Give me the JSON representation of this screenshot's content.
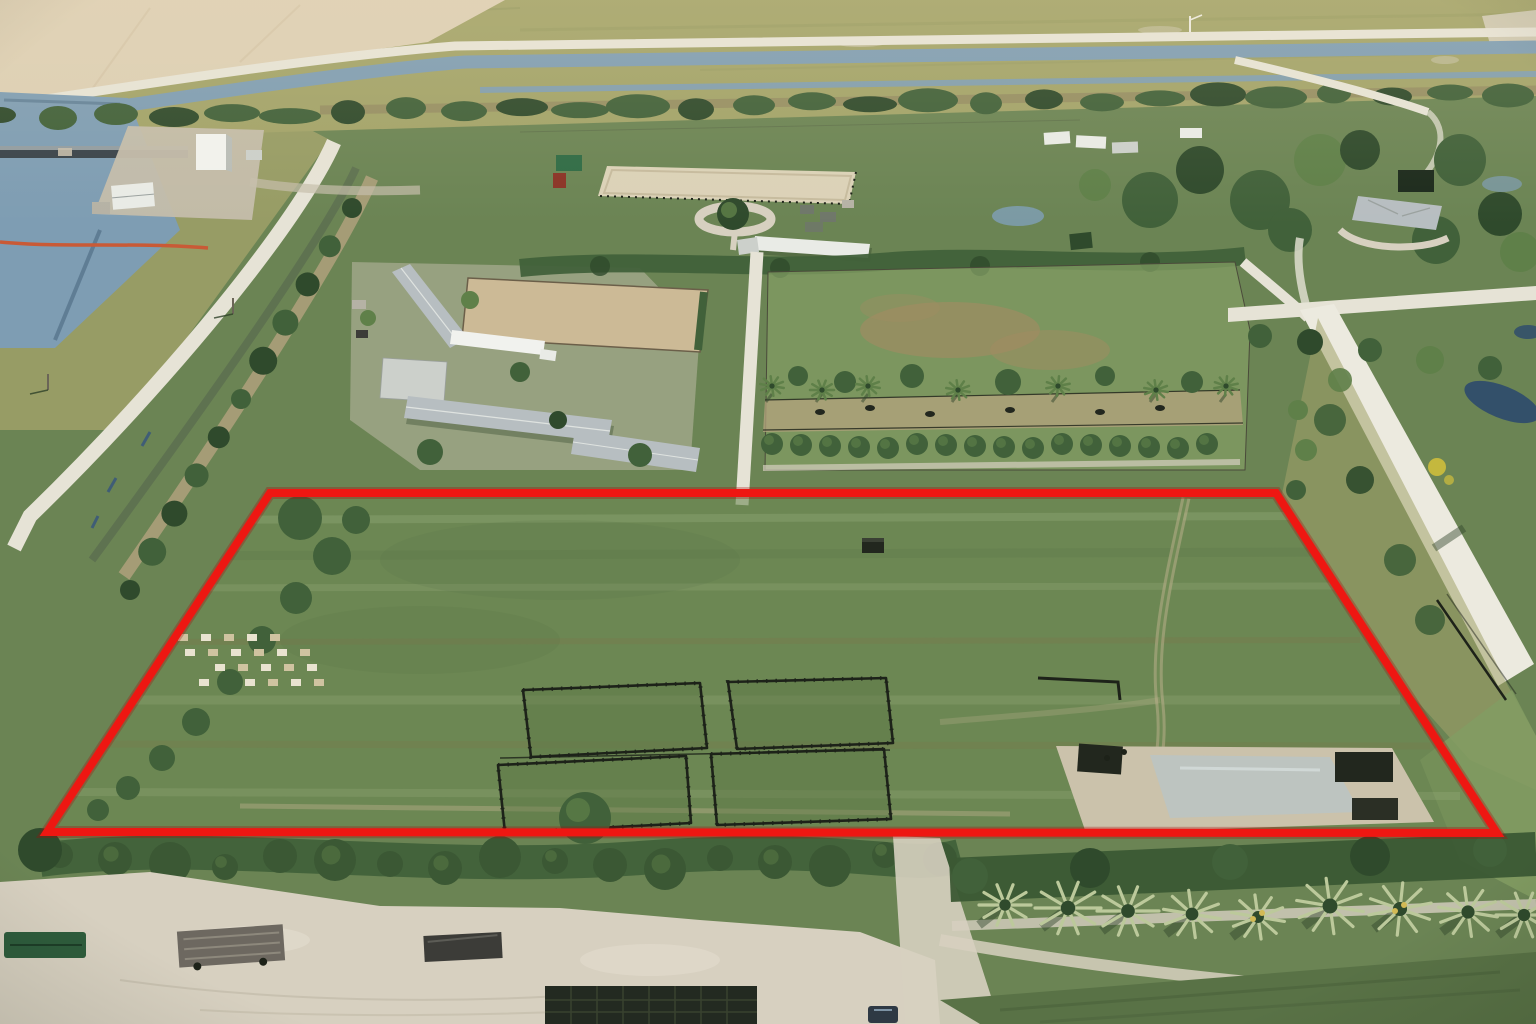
{
  "scene": {
    "kind": "aerial-drone-photo",
    "subject": "Aerial drone photo of a vacant grass parcel outlined in red, surrounded by rural equestrian farms, canals, levee roads, paddocks, palm trees and sandy lanes",
    "width_px": 1536,
    "height_px": 1024
  },
  "parcel": {
    "boundary_points": "270,493 1276,493 1497,833 47,832",
    "boundary_stroke_px": 8
  },
  "palette": {
    "red": "#ee1712",
    "red_halo": "#a80b0b",
    "grass": "#6b8454",
    "grass_light": "#829c63",
    "grass_dark": "#597246",
    "lawn": "#7fa05c",
    "parcel_grass": "#6d8953",
    "paddock_grass": "#5e7847",
    "field_tan": "#dccfb4",
    "marsh": "#a2a369",
    "marsh_dark": "#878f58",
    "water": "#7e9db3",
    "water_dark": "#3f5d76",
    "pond_dark": "#33506a",
    "road_white": "#e6e3d6",
    "road_bright": "#eceadf",
    "road_dirt": "#b4a37e",
    "track": "#b9ae8a",
    "sand": "#d7d0c0",
    "sand_dark": "#c4bdab",
    "dirt_band": "#8c7f5f",
    "ditch": "#5d7050",
    "tree": "#41613a",
    "tree_light": "#5f8049",
    "tree_dark": "#2f4a2c",
    "hedge": "#3b5834",
    "palm_pale": "#bcc99b",
    "palm_yellow": "#d2ba55",
    "palm_shadow": "#31452c",
    "roof_white": "#e9ebe6",
    "roof_gray": "#b7bec1",
    "roof_flat": "#ccd0cb",
    "roof_green": "#2f6b45",
    "roof_line": "#9aa19f",
    "bldg_white": "#f1f2ee",
    "bldg_shade": "#b9bdb7",
    "shed_gray": "#b5b2a5",
    "shed_slate": "#6f776a",
    "shed_red": "#8a3326",
    "arena": "#dbd2b8",
    "arena_line": "#c6bb9e",
    "dirt_paddock": "#ccba96",
    "fence": "#1d2219",
    "shadow": "#2e4128",
    "boom": "#c95a36",
    "dam": "#39434a",
    "dam_light": "#a9b3b7",
    "hive_a": "#e9e3d0",
    "hive_b": "#cfc3a0",
    "debris": "#22271e",
    "wet": "#b9c4c6",
    "wet_sand": "#cbc2ab",
    "trailer_deck": "#6d6860",
    "trailer_dark": "#3c3c38",
    "boat_green": "#2e5c3c",
    "tarp": "#232a21",
    "tarp_seam": "#39422f",
    "car": "#2e3944",
    "pole": "#6b6557",
    "streak_light": "#d6e0b8",
    "streak_brown": "#7e744b",
    "patch_brown": "#a18c62",
    "bush_yellow": "#c4b83e"
  },
  "generated": {
    "treeline_top": {
      "x_start": 0,
      "x_end": 1536,
      "step": 58,
      "y_left": 118,
      "y_right": 92
    },
    "diag_trees": {
      "x1": 352,
      "y1": 208,
      "x2": 130,
      "y2": 590,
      "n": 11
    },
    "parcel_left_trees": [
      [
        300,
        518,
        22
      ],
      [
        332,
        556,
        19
      ],
      [
        296,
        598,
        16
      ],
      [
        262,
        640,
        14
      ],
      [
        230,
        682,
        13
      ],
      [
        196,
        722,
        14
      ],
      [
        162,
        758,
        13
      ],
      [
        128,
        788,
        12
      ],
      [
        98,
        810,
        11
      ],
      [
        356,
        520,
        14
      ]
    ],
    "beehives": {
      "x": 178,
      "y": 634,
      "cols": 6,
      "rows": 4,
      "dx": 23,
      "dy": 15,
      "row_shift": 7,
      "w": 10,
      "h": 7
    },
    "paddocks": [
      {
        "points": "523,690 700,683 707,748 531,757"
      },
      {
        "points": "728,682 886,678 893,743 737,749"
      },
      {
        "points": "498,765 686,756 691,823 505,833"
      },
      {
        "points": "711,754 884,749 891,819 717,825"
      }
    ],
    "pasture_palms": {
      "y": 386,
      "xs": [
        772,
        822,
        868,
        958,
        1058,
        1156,
        1226
      ]
    },
    "pasture_bushes": {
      "y": 376,
      "xs": [
        798,
        845,
        912,
        1008,
        1105,
        1192
      ]
    },
    "shrub_row": {
      "y": 446,
      "x_start": 772,
      "x_end": 1233,
      "step": 29
    },
    "hedge_bushes": {
      "y": 862,
      "x_start": 60,
      "x_end": 940,
      "step": 55
    },
    "bottom_palms": {
      "y": 912,
      "xs": [
        1005,
        1068,
        1128,
        1192,
        1258,
        1330,
        1400,
        1468,
        1524
      ],
      "accent_xs": [
        1258,
        1400
      ]
    }
  }
}
